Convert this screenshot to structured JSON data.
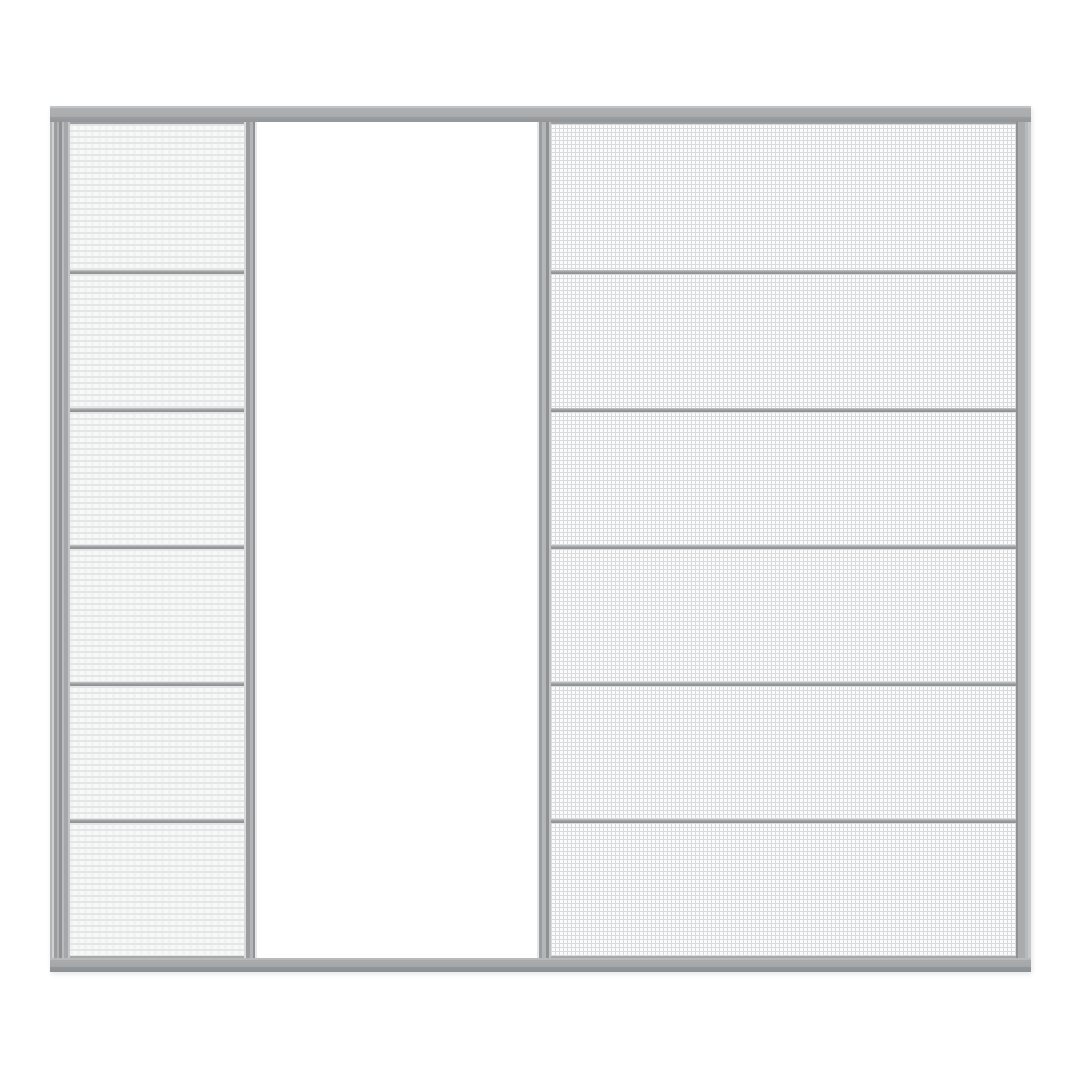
{
  "meta": {
    "type": "product-render",
    "subject": "three-track sliding insect screen door system",
    "background": "#ffffff"
  },
  "door": {
    "layout": [
      "left-frame-track",
      "pleated-screen-panel",
      "pleated-panel-stile",
      "open-doorway",
      "mesh-panel-stile",
      "mesh-screen-panel",
      "right-frame-track"
    ],
    "rails": {
      "top": "top-track-rail",
      "bottom": "bottom-track-rail"
    },
    "panels": [
      {
        "id": "pleated",
        "name": "pleated-screen-panel",
        "texture": "pleated-horizontal-weave",
        "sections": 6
      },
      {
        "id": "mesh",
        "name": "mesh-screen-panel",
        "texture": "fine-square-mesh",
        "sections": 6
      }
    ],
    "opening": {
      "name": "open-doorway",
      "fill": "#ffffff"
    }
  },
  "colors": {
    "frame": "#a9abad",
    "frame_light": "#c6c8c9",
    "frame_dark": "#8f9294",
    "divider": "#9a9da0",
    "pleat_stripe": "#e4e6e6",
    "pleat_bg": "#f7f8f8",
    "mesh_line": "#d9dadb",
    "mesh_bg": "#fbfbfb",
    "background": "#ffffff"
  }
}
